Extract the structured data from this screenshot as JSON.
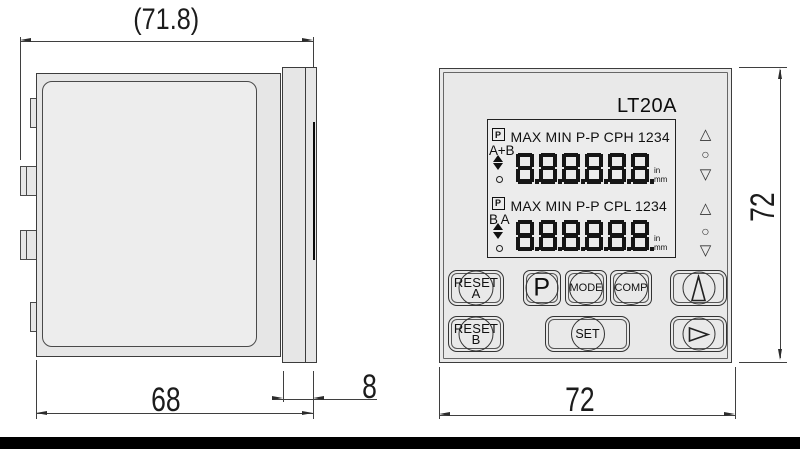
{
  "colors": {
    "background": "#ffffff",
    "line": "#3c3c3c",
    "fill_gray": "#e8e8e8",
    "lcd_segment": "#161616",
    "bottom_bar": "#000000"
  },
  "side_view": {
    "dim_overall": "(71.8)",
    "dim_case_depth": "68",
    "dim_bezel_depth": "8"
  },
  "front_view": {
    "model": "LT20A",
    "dim_width": "72",
    "dim_height": "72",
    "display": {
      "rows": [
        {
          "preset_icon": "P",
          "status_labels": "MAX MIN P-P CPH 1234",
          "channel": "A+B",
          "digits": "8.8.8.8.8.8.",
          "unit_top": "in",
          "unit_bottom": "mm"
        },
        {
          "preset_icon": "P",
          "status_labels": "MAX MIN P-P CPL 1234",
          "channel": "B A",
          "digits": "8.8.8.8.8.8.",
          "unit_top": "in",
          "unit_bottom": "mm"
        }
      ]
    },
    "indicators": {
      "up_glyph": "△",
      "circle_glyph": "○",
      "down_glyph": "▽"
    },
    "buttons": {
      "reset_a_line1": "RESET",
      "reset_a_line2": "A",
      "preset": "P",
      "mode": "MODE",
      "comp": "COMP",
      "reset_b_line1": "RESET",
      "reset_b_line2": "B",
      "set": "SET"
    }
  }
}
